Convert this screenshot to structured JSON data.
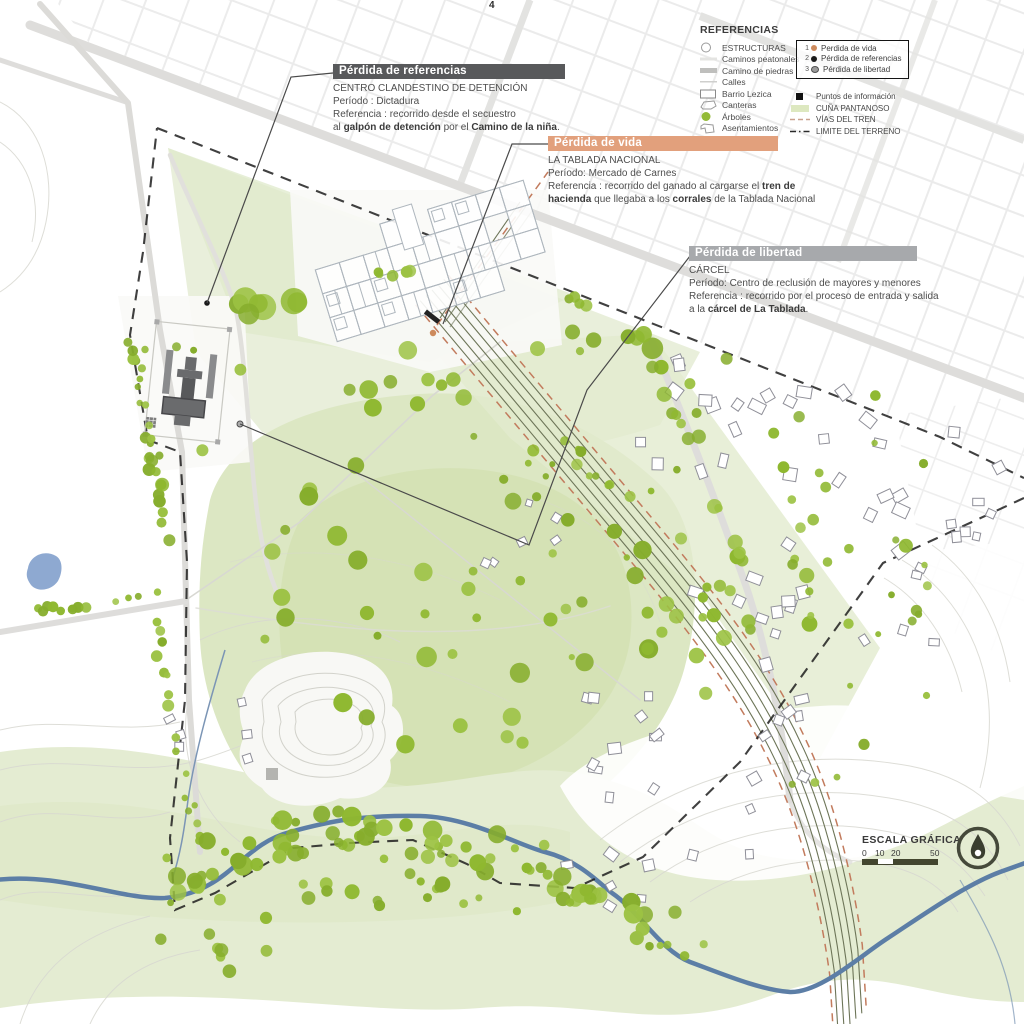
{
  "page": {
    "number": "4"
  },
  "legend": {
    "title": "REFERENCIAS",
    "items": [
      {
        "icon": "structure-circle-icon",
        "label": "ESTRUCTURAS"
      },
      {
        "icon": "footpath-line-icon",
        "label": "Caminos peatonales"
      },
      {
        "icon": "stone-road-line-icon",
        "label": "Camino de piedras"
      },
      {
        "icon": "street-line-icon",
        "label": "Calles"
      },
      {
        "icon": "barrio-rect-icon",
        "label": "Barrio Lezica"
      },
      {
        "icon": "quarry-shape-icon",
        "label": "Canteras"
      },
      {
        "icon": "tree-dot-icon",
        "label": "Árboles"
      },
      {
        "icon": "settlement-poly-icon",
        "label": "Asentamientos"
      }
    ],
    "numbered": [
      {
        "num": "1",
        "color": "#cd8a5c",
        "label": "Perdida de vida"
      },
      {
        "num": "2",
        "color": "#1a1a1a",
        "label": "Pérdida de referencias"
      },
      {
        "num": "3",
        "color": "#9b9b9b",
        "label": "Pérdida de libertad"
      }
    ],
    "extra": [
      {
        "icon": "info-square-icon",
        "label": "Puntos de información"
      },
      {
        "icon": "swamp-swatch-icon",
        "label": "CUÑA PANTANOSO"
      },
      {
        "icon": "rail-dash-icon",
        "label": "VÍAS DEL TREN"
      },
      {
        "icon": "limit-dash-icon",
        "label": "LIMITE DEL TERRENO"
      }
    ]
  },
  "annotations": [
    {
      "title": "Pérdida de referencias",
      "header_color": "#58595b",
      "lines": [
        [
          {
            "t": "CENTRO CLANDESTINO DE DETENCIÓN"
          }
        ],
        [
          {
            "t": "Período : Dictadura"
          }
        ],
        [
          {
            "t": "Referencia : recorrido desde el secuestro"
          }
        ],
        [
          {
            "t": "al "
          },
          {
            "t": "galpón de detención",
            "b": true
          },
          {
            "t": " por el "
          },
          {
            "t": "Camino de la niña",
            "b": true
          },
          {
            "t": "."
          }
        ]
      ]
    },
    {
      "title": "Pérdida de vida",
      "header_color": "#e2a07c",
      "lines": [
        [
          {
            "t": "LA TABLADA NACIONAL"
          }
        ],
        [
          {
            "t": "Período: Mercado de Carnes"
          }
        ],
        [
          {
            "t": "Referencia : recorrido del ganado al cargarse el "
          },
          {
            "t": "tren de",
            "b": true
          }
        ],
        [
          {
            "t": "hacienda",
            "b": true
          },
          {
            "t": " que llegaba a los "
          },
          {
            "t": "corrales",
            "b": true
          },
          {
            "t": " de la Tablada Nacional"
          }
        ]
      ]
    },
    {
      "title": "Pérdida de libertad",
      "header_color": "#a7a9ac",
      "lines": [
        [
          {
            "t": "CÁRCEL"
          }
        ],
        [
          {
            "t": "Período: Centro de reclusión de mayores y menores"
          }
        ],
        [
          {
            "t": "Referencia : recorrido por el proceso de entrada y salida"
          }
        ],
        [
          {
            "t": " a la "
          },
          {
            "t": "cárcel de La Tablada",
            "b": true
          },
          {
            "t": "."
          }
        ]
      ]
    }
  ],
  "scale": {
    "title": "ESCALA GRÁFICA",
    "ticks": [
      "0",
      "10",
      "20",
      "50"
    ]
  },
  "colors": {
    "tree_green": "#93ba37",
    "swamp_green": "#e3ecd0",
    "stream_blue": "#5c7ea6",
    "rail_salmon": "#c27b5d",
    "limit_black": "#1f1f1f",
    "header_dark": "#58595b",
    "header_salmon": "#e2a07c",
    "header_gray": "#a7a9ac"
  }
}
